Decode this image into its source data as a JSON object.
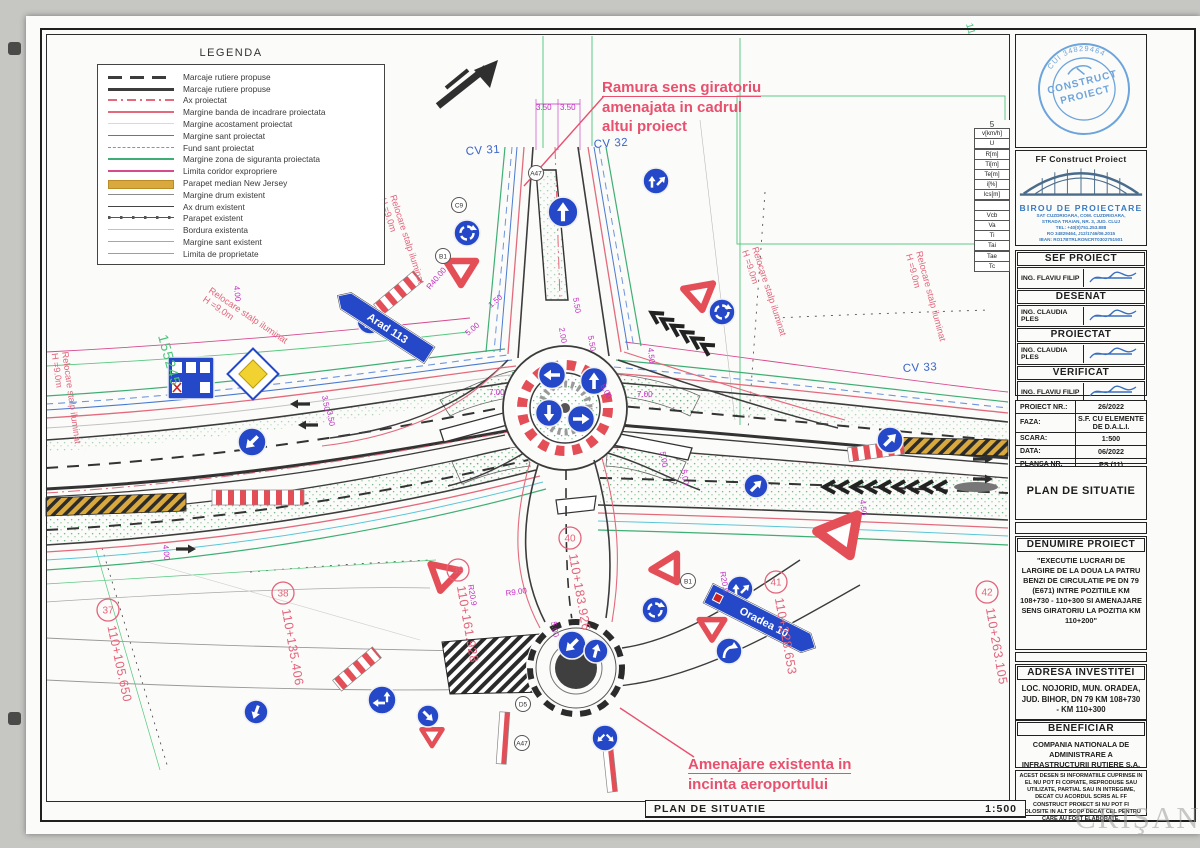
{
  "sheet": {
    "footer_title": "PLAN DE SITUATIE",
    "footer_scale": "1:500",
    "watermark": "CRIŞANA"
  },
  "legend": {
    "title": "LEGENDA",
    "items": [
      {
        "label": "Marcaje rutiere propuse",
        "style": "dash-thick"
      },
      {
        "label": "Marcaje rutiere propuse",
        "style": "solid-thick"
      },
      {
        "label": "Ax proiectat",
        "style": "axp"
      },
      {
        "label": "Margine banda de incadrare proiectata",
        "style": "banda"
      },
      {
        "label": "Margine acostament proiectat",
        "style": "acost"
      },
      {
        "label": "Margine sant proiectat",
        "style": "sant"
      },
      {
        "label": "Fund sant proiectat",
        "style": "fund"
      },
      {
        "label": "Margine zona de siguranta proiectata",
        "style": "zona"
      },
      {
        "label": "Limita coridor expropriere",
        "style": "exprop"
      },
      {
        "label": "Parapet median New Jersey",
        "style": "nj"
      },
      {
        "label": "Margine drum existent",
        "style": "drum-ex"
      },
      {
        "label": "Ax drum existent",
        "style": "ax-ex"
      },
      {
        "label": "Parapet existent",
        "style": "parapet-ex"
      },
      {
        "label": "Bordura existenta",
        "style": "bordura"
      },
      {
        "label": "Margine sant existent",
        "style": "sant-ex"
      },
      {
        "label": "Limita de proprietate",
        "style": "proprietate"
      }
    ]
  },
  "annotations": {
    "ramura_line1": "Ramura sens giratoriu",
    "ramura_line2": "amenajata in cadrul",
    "ramura_line3": "altui proiect",
    "amenajare_line1": "Amenajare existenta in",
    "amenajare_line2": "incinta aeroportului"
  },
  "plan_labels": {
    "cv": [
      {
        "t": "CV 31",
        "x": 466,
        "y": 155,
        "r": -4
      },
      {
        "t": "CV 32",
        "x": 594,
        "y": 148,
        "r": -4
      },
      {
        "t": "CV 33",
        "x": 903,
        "y": 372,
        "r": -3
      }
    ],
    "km": [
      {
        "n": "37",
        "t": "110+105.650",
        "x": 108,
        "y": 610,
        "r": 78
      },
      {
        "n": "38",
        "t": "110+135.406",
        "x": 283,
        "y": 593,
        "r": 80
      },
      {
        "n": "39",
        "t": "110+161.928",
        "x": 458,
        "y": 570,
        "r": 80
      },
      {
        "n": "40",
        "t": "110+183.926",
        "x": 570,
        "y": 538,
        "r": 80
      },
      {
        "n": "41",
        "t": "110+228.653",
        "x": 776,
        "y": 582,
        "r": 80
      },
      {
        "n": "42",
        "t": "110+263.105",
        "x": 987,
        "y": 592,
        "r": 80
      }
    ],
    "relocare_text": {
      "line1": "Relocare stalp iluminat",
      "line2": "H =9.0m"
    },
    "relocare_pos": [
      {
        "x": 208,
        "y": 292,
        "r": 34
      },
      {
        "x": 390,
        "y": 196,
        "r": 72
      },
      {
        "x": 62,
        "y": 352,
        "r": 82
      },
      {
        "x": 752,
        "y": 248,
        "r": 72
      },
      {
        "x": 916,
        "y": 252,
        "r": 75
      }
    ],
    "green": [
      {
        "t": "155245",
        "x": 158,
        "y": 336,
        "r": 75,
        "s": 14
      },
      {
        "t": "11",
        "x": 966,
        "y": 24,
        "r": 75,
        "s": 10
      }
    ],
    "dims": [
      {
        "t": "3.50",
        "x": 536,
        "y": 110,
        "r": 0
      },
      {
        "t": "3.50",
        "x": 560,
        "y": 110,
        "r": 0
      },
      {
        "t": "7.00",
        "x": 489,
        "y": 395,
        "r": 0
      },
      {
        "t": "7.00",
        "x": 637,
        "y": 397,
        "r": 0
      },
      {
        "t": "4.50",
        "x": 648,
        "y": 348,
        "r": 85
      },
      {
        "t": "4.50",
        "x": 860,
        "y": 500,
        "r": 85
      },
      {
        "t": "5.50",
        "x": 573,
        "y": 298,
        "r": 80
      },
      {
        "t": "5.50",
        "x": 588,
        "y": 336,
        "r": 80
      },
      {
        "t": "2.00",
        "x": 559,
        "y": 328,
        "r": 80
      },
      {
        "t": "8.00",
        "x": 600,
        "y": 386,
        "r": 60
      },
      {
        "t": "5.00",
        "x": 468,
        "y": 336,
        "r": -40
      },
      {
        "t": "5.00",
        "x": 660,
        "y": 452,
        "r": 80
      },
      {
        "t": "5.00",
        "x": 681,
        "y": 470,
        "r": 80
      },
      {
        "t": "5.00",
        "x": 551,
        "y": 622,
        "r": 80
      },
      {
        "t": "1.50",
        "x": 491,
        "y": 308,
        "r": -40
      },
      {
        "t": "4.00",
        "x": 163,
        "y": 545,
        "r": 85
      },
      {
        "t": "4.00",
        "x": 234,
        "y": 286,
        "r": 85
      },
      {
        "t": "3.50",
        "x": 322,
        "y": 396,
        "r": 80
      },
      {
        "t": "3.50",
        "x": 327,
        "y": 411,
        "r": 80
      },
      {
        "t": "R40.00",
        "x": 430,
        "y": 290,
        "r": -50
      },
      {
        "t": "R20.0",
        "x": 720,
        "y": 572,
        "r": 80
      },
      {
        "t": "R20.9",
        "x": 468,
        "y": 585,
        "r": 80
      },
      {
        "t": "R9.00",
        "x": 506,
        "y": 596,
        "r": -8
      }
    ],
    "sign_codes": [
      {
        "t": "C9",
        "x": 459,
        "y": 205
      },
      {
        "t": "B1",
        "x": 443,
        "y": 256
      },
      {
        "t": "A47",
        "x": 536,
        "y": 173
      },
      {
        "t": "B1",
        "x": 688,
        "y": 581
      },
      {
        "t": "D5",
        "x": 523,
        "y": 704
      },
      {
        "t": "A47",
        "x": 522,
        "y": 743
      }
    ],
    "direction_signs": {
      "arad": "Arad 113",
      "oradea": "Oradea 10"
    }
  },
  "curve_table": {
    "header": "5",
    "rows": [
      "v[km/h]",
      "U",
      "R[m]",
      "Ti[m]",
      "Te[m]",
      "i[%]",
      "lcs[m]",
      "",
      "Vcb",
      "Va",
      "Ti",
      "Tai",
      "Tae",
      "Tc"
    ]
  },
  "titleblock": {
    "stamp": {
      "ring": "CUI 34829464",
      "line1": "CONSTRUCT",
      "line2": "PROIECT"
    },
    "company": "FF Construct Proiect",
    "office": "BIROU DE PROIECTARE",
    "address": [
      "SAT CUZDRIOARA, COM. CUZDRIOARA,",
      "STRADA TRAIAN, NR. 3, JUD. CLUJ",
      "TEL: +40(0)751.253.888",
      "RO 34829464, J12/1746/06.2015",
      "IBAN: RO17BTRLRONCRT0302751501"
    ],
    "roles": [
      {
        "title": "SEF PROIECT",
        "name": "ING. FLAVIU FILIP"
      },
      {
        "title": "DESENAT",
        "name": "ING. CLAUDIA PLES"
      },
      {
        "title": "PROIECTAT",
        "name": "ING. CLAUDIA PLES"
      },
      {
        "title": "VERIFICAT",
        "name": "ING. FLAVIU FILIP"
      }
    ],
    "fields": [
      {
        "label": "PROIECT NR.:",
        "value": "26/2022"
      },
      {
        "label": "FAZA:",
        "value": "S.F. CU ELEMENTE DE D.A.L.I."
      },
      {
        "label": "SCARA:",
        "value": "1:500"
      },
      {
        "label": "DATA:",
        "value": "06/2022"
      },
      {
        "label": "PLANSA NR.",
        "value": "PS (11)"
      }
    ],
    "plan_name": "PLAN DE SITUATIE",
    "denumire_heading": "DENUMIRE PROIECT",
    "denumire_text": "\"EXECUTIE LUCRARI DE LARGIRE DE LA DOUA LA PATRU BENZI DE CIRCULATIE PE DN 79 (E671) INTRE POZITIILE KM 108+730 - 110+300 SI AMENAJARE SENS GIRATORIU LA POZITIA KM 110+200\"",
    "adresa_heading": "ADRESA INVESTITEI",
    "adresa_text": "LOC. NOJORID, MUN. ORADEA, JUD. BIHOR, DN 79 KM 108+730 - KM 110+300",
    "beneficiar_heading": "BENEFICIAR",
    "beneficiar_text": "COMPANIA NATIONALA DE ADMINISTRARE A INFRASTRUCTURII RUTIERE S.A.",
    "disclaimer": "ACEST DESEN SI INFORMATIILE CUPRINSE IN EL NU POT FI COPIATE, REPRODUSE SAU UTILIZATE, PARTIAL SAU IN INTREGIME, DECAT CU ACORDUL SCRIS AL FF CONSTRUCT PROIECT SI NU POT FI FOLOSITE IN ALT SCOP DECAT CEL PENTRU CARE AU FOST ELABORATE."
  }
}
